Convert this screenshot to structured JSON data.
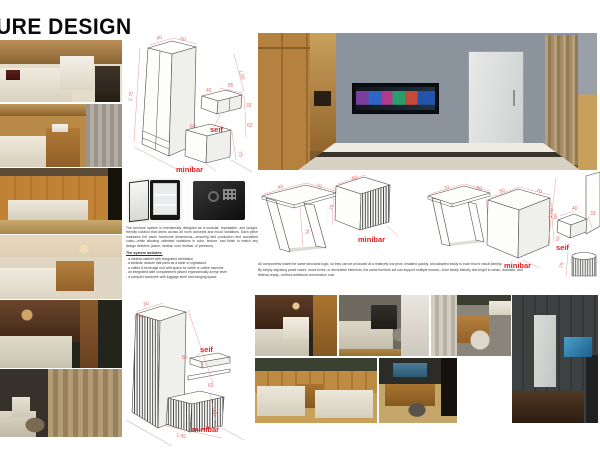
{
  "title": "URE DESIGN",
  "colors": {
    "dim_red": "#e06e6e",
    "label_red": "#d92121",
    "title_black": "#0b0b0b"
  },
  "left_text": {
    "intro": "The furniture system is intentionally designed as a modular, repeatable, and budget-friendly solution that works across all room concepts and mood variations. Each piece maintains the same functional dimensions—ensuring fast production and consistent costs—while allowing unlimited variations in color, texture, and finish to match any design direction (warm, neutral, cool, festival, or premium).",
    "includes_heading": "The system includes:",
    "bullets": [
      "- a minibar cabinet with integrated ventilation",
      "- a bedside module that pairs as a table or nightstand",
      "- a coffee & beverage unit with space for kettle or coffee machine",
      "- an integrated safe compartment placed ergonomically at eye level",
      "- a compact wardrobe with luggage shelf and hanging space"
    ]
  },
  "right_text": {
    "p1": "All components share the same structural logic, so they can be produced at a relatively low price, installed quickly, and adapted easily to each floor's visual identity.",
    "p2": "By simply adjusting panel colors, wood tones, or decorative elements, the same furniture set can support multiple moods—from family-friendly and bright to urban, dramatic, and festival-ready—without additional construction cost."
  },
  "drawings": {
    "wardrobe_top": {
      "dim_top_w": "60",
      "dim_top_d": "60",
      "dim_height": "2.75",
      "dim_right": "1.00",
      "dim_shelf_d": "40",
      "dim_shelf_w": "85",
      "dim_shelf_h": "33",
      "dim_mid": "62",
      "dim_base_w": "60",
      "dim_base_h": "75",
      "label_seif": "seif",
      "label_minibar": "minibar"
    },
    "desk_1": {
      "dim_d": "40",
      "dim_w": "70",
      "dim_h": "75"
    },
    "minibar_1": {
      "dim_top": "60",
      "dim_h": "75",
      "label": "minibar"
    },
    "desk_2": {
      "dim_w": "70",
      "dim_d": "60",
      "dim_h": "75"
    },
    "minibar_2": {
      "dim_a": "60",
      "dim_b": "70",
      "dim_c": "60",
      "dim_h": "75",
      "label": "minibar"
    },
    "seif_unit": {
      "dim_h": "1.00",
      "dim_w": "40",
      "dim_d": "33",
      "dim_base": "75",
      "label": "seif"
    },
    "wardrobe_bottom": {
      "dim_top_w": "60",
      "dim_top_d": "60",
      "dim_shelf": "85",
      "dim_base_w": "60",
      "dim_base_h": "75",
      "dim_total": "1.65",
      "label_seif": "seif",
      "label_minibar": "minibar"
    }
  }
}
